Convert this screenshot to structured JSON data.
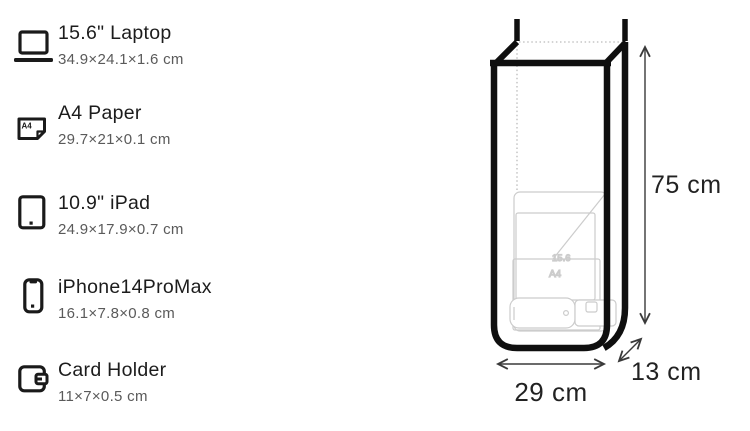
{
  "sidebar": {
    "items": [
      {
        "label": "15.6\" Laptop",
        "dimensions": "34.9×24.1×1.6 cm",
        "icon": "laptop-icon"
      },
      {
        "label": "A4 Paper",
        "dimensions": "29.7×21×0.1 cm",
        "icon": "a4-paper-icon"
      },
      {
        "label": "10.9\" iPad",
        "dimensions": "24.9×17.9×0.7 cm",
        "icon": "ipad-icon"
      },
      {
        "label": "iPhone14ProMax",
        "dimensions": "16.1×7.8×0.8 cm",
        "icon": "iphone-icon"
      },
      {
        "label": "Card Holder",
        "dimensions": "11×7×0.5 cm",
        "icon": "card-holder-icon"
      }
    ],
    "a4_icon_label": "A4"
  },
  "diagram": {
    "height_label": "75 cm",
    "width_label": "29 cm",
    "depth_label": "13 cm",
    "laptop_diagonal_label": "15.6",
    "paper_label": "A4"
  },
  "colors": {
    "bag_outline": "#0f0f0f",
    "faint_item_outline": "#cccccc",
    "dashed_hidden_edge": "#bbbbbb",
    "arrow": "#3a3a3a",
    "text_primary": "#1c1c1c",
    "text_secondary": "#5a5a5a"
  }
}
